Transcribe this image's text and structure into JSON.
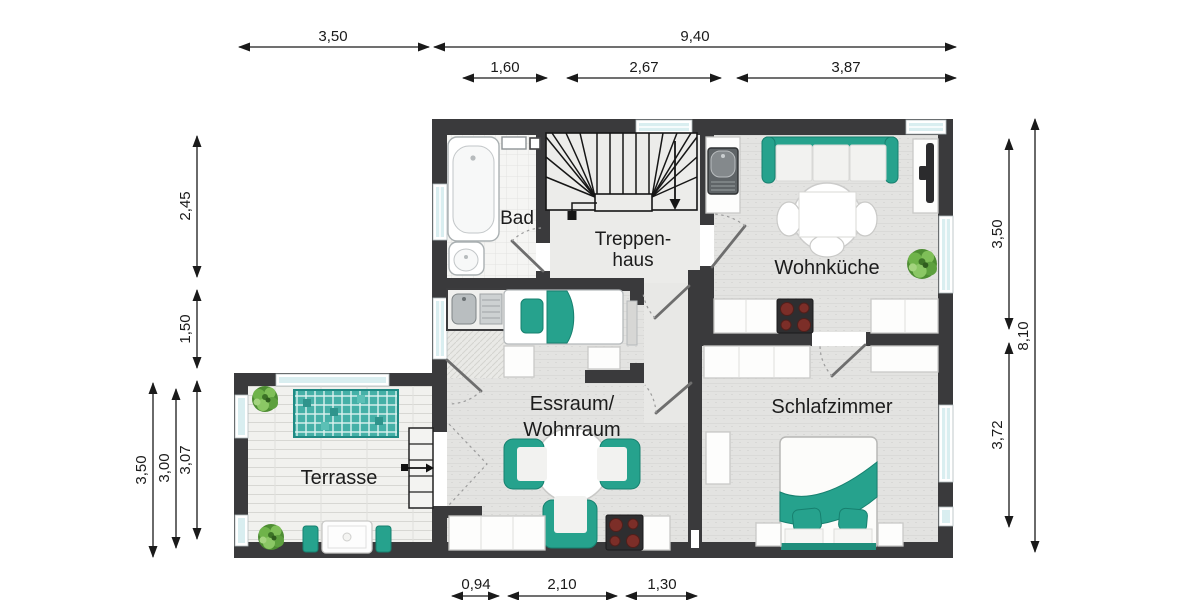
{
  "plan": {
    "title": "floor-plan",
    "rooms": {
      "bad": "Bad",
      "treppenhaus_line1": "Treppen-",
      "treppenhaus_line2": "haus",
      "wohnkueche": "Wohnküche",
      "essraum_line1": "Essraum/",
      "essraum_line2": "Wohnraum",
      "schlafzimmer": "Schlafzimmer",
      "terrasse": "Terrasse"
    },
    "dims": {
      "top_terrace": "3,50",
      "top_main": "9,40",
      "top_bad": "1,60",
      "top_stair": "2,67",
      "top_kitchen": "3,87",
      "left_bad": "2,45",
      "left_niche": "1,50",
      "left_terrace_outer": "3,50",
      "left_terrace_mid": "3,00",
      "left_terrace_inner": "3,07",
      "right_kitchen": "3,50",
      "right_bedroom": "3,72",
      "right_total": "8,10",
      "bottom_door": "0,94",
      "bottom_dining": "2,10",
      "bottom_hall": "1,30"
    },
    "colors": {
      "wall": "#3a3a3c",
      "teal": "#26a28d",
      "window_glass": "#d9eef0",
      "floor": "#e3e3e1",
      "burner": "#7c2e28"
    }
  }
}
